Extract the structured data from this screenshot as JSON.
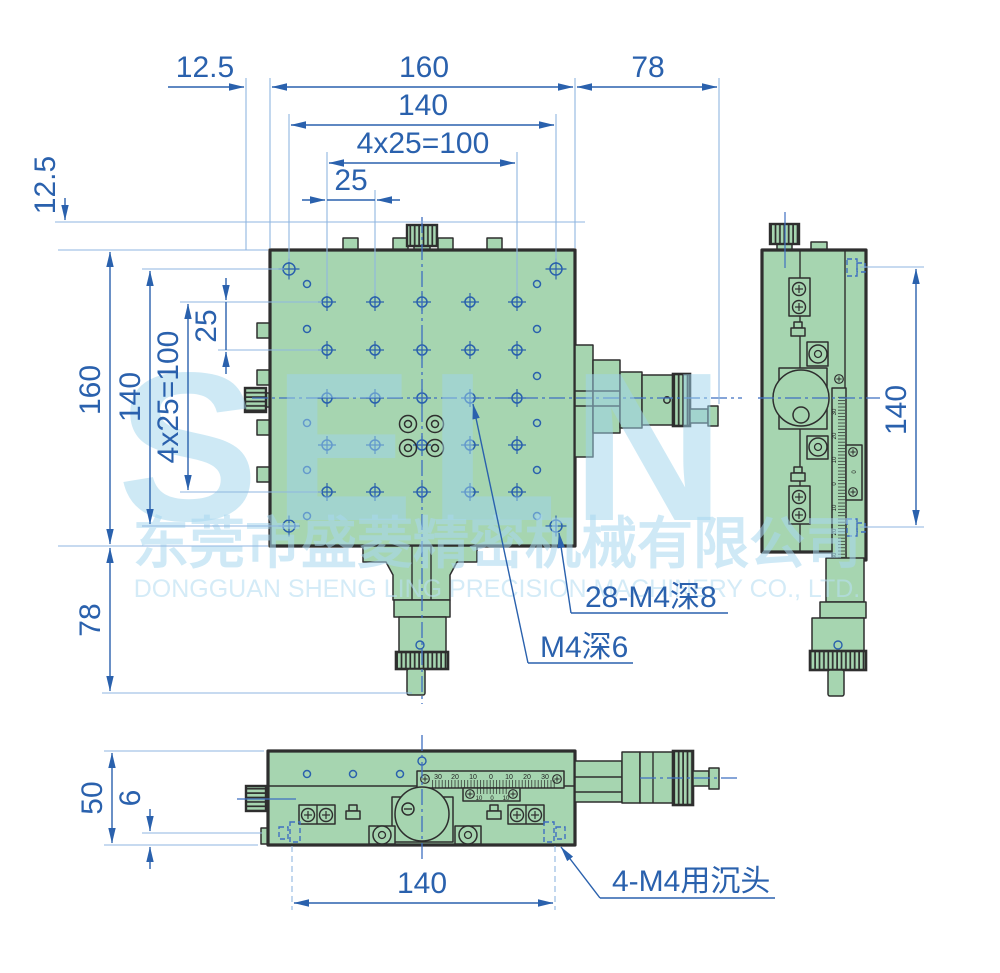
{
  "watermark": {
    "brand": "SELN",
    "company_cn": "东莞市盛菱精密机械有限公司",
    "company_en": "DONGGUAN SHENG LING PRECISION MACHINERY CO., LTD."
  },
  "dims": {
    "top_offset": "12.5",
    "top_width": "160",
    "top_right": "78",
    "top_hole_span": "140",
    "top_grid": "4x25=100",
    "top_pitch": "25",
    "left_offset": "12.5",
    "left_height": "160",
    "left_hole_span": "140",
    "left_grid": "4x25=100",
    "left_pitch": "25",
    "left_lower": "78",
    "side_span": "140",
    "bottom_height": "50",
    "bottom_step": "6",
    "bottom_span": "140"
  },
  "callouts": {
    "grid_holes": "28-M4深8",
    "center_hole": "M4深6",
    "counterbore": "4-M4用沉头"
  },
  "scales": {
    "bottom_main": [
      "30",
      "20",
      "10",
      "0",
      "10",
      "20",
      "30"
    ],
    "bottom_vernier": [
      "10",
      "0",
      "10"
    ],
    "side_main": [
      "30",
      "20",
      "10",
      "0",
      "10",
      "20",
      "30"
    ],
    "side_vernier": [
      "10",
      "0",
      "10"
    ]
  },
  "colors": {
    "body_green": "#a6d5b0",
    "outline": "#2e2e2e",
    "dimension_blue": "#2a61ad",
    "construction_blue": "#8fb6e0",
    "hidden_blue": "#3f6fc1",
    "watermark_cyan": "#b9e0f2"
  }
}
